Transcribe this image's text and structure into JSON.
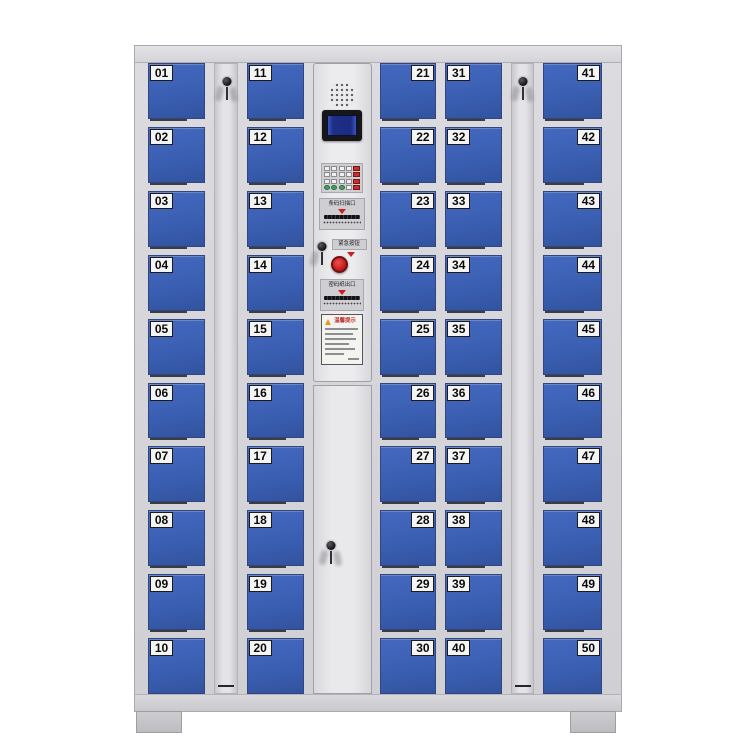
{
  "product": {
    "type": "smart-electronic-locker-cabinet",
    "door_count": 50
  },
  "cabinet": {
    "columns": [
      {
        "id": "doors-01-10",
        "label_side": "left",
        "numbers": [
          "01",
          "02",
          "03",
          "04",
          "05",
          "06",
          "07",
          "08",
          "09",
          "10"
        ]
      },
      {
        "id": "doors-11-20",
        "label_side": "left",
        "numbers": [
          "11",
          "12",
          "13",
          "14",
          "15",
          "16",
          "17",
          "18",
          "19",
          "20"
        ]
      },
      {
        "id": "doors-21-30",
        "label_side": "right",
        "numbers": [
          "21",
          "22",
          "23",
          "24",
          "25",
          "26",
          "27",
          "28",
          "29",
          "30"
        ]
      },
      {
        "id": "doors-31-40",
        "label_side": "left",
        "numbers": [
          "31",
          "32",
          "33",
          "34",
          "35",
          "36",
          "37",
          "38",
          "39",
          "40"
        ]
      },
      {
        "id": "doors-41-50",
        "label_side": "right",
        "numbers": [
          "41",
          "42",
          "43",
          "44",
          "45",
          "46",
          "47",
          "48",
          "49",
          "50"
        ]
      }
    ],
    "key_strip_count": 2
  },
  "control_panel": {
    "scanner_label": "条码扫描口",
    "emergency_label": "紧急按钮",
    "outlet_label": "密码纸出口",
    "notice_title": "温馨提示"
  },
  "colors": {
    "door_blue": "#3a5fb2",
    "frame_gray": "#d7d7db",
    "screen_blue": "#1e2f86",
    "accent_red": "#c41e1e"
  }
}
